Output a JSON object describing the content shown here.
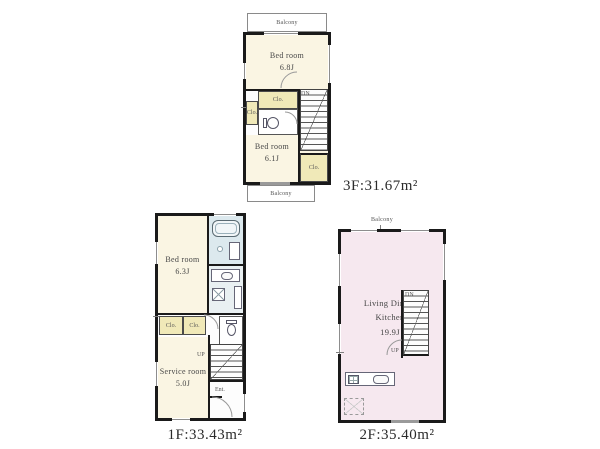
{
  "colors": {
    "wall": "#1a1a1a",
    "room_cream": "#faf5e3",
    "closet_yellow": "#f0e9b8",
    "bath_blue": "#dce9ee",
    "washroom_blue": "#e9f0f2",
    "ldk_pink": "#f6e8ef"
  },
  "floor3": {
    "balcony_top": "Balcony",
    "balcony_bottom": "Balcony",
    "bedroom_a_name": "Bed room",
    "bedroom_a_size": "6.8J",
    "closet_small": "Clo.",
    "closet_mid": "Clo.",
    "closet_bottom": "Clo.",
    "stairs_dn": "DN",
    "bedroom_b_name": "Bed room",
    "bedroom_b_size": "6.1J",
    "area": "3F:31.67m²"
  },
  "floor1": {
    "bedroom_name": "Bed room",
    "bedroom_size": "6.3J",
    "closet_a": "Clo.",
    "closet_b": "Clo.",
    "service_name": "Service room",
    "service_size": "5.0J",
    "stairs_up": "UP",
    "entrance": "Ent.",
    "area": "1F:33.43m²"
  },
  "floor2": {
    "balcony": "Balcony",
    "ldk_line1": "Living Dining",
    "ldk_line2": "Kitchen",
    "ldk_size": "19.9J",
    "stairs_dn": "DN",
    "stairs_up": "UP",
    "area": "2F:35.40m²"
  }
}
